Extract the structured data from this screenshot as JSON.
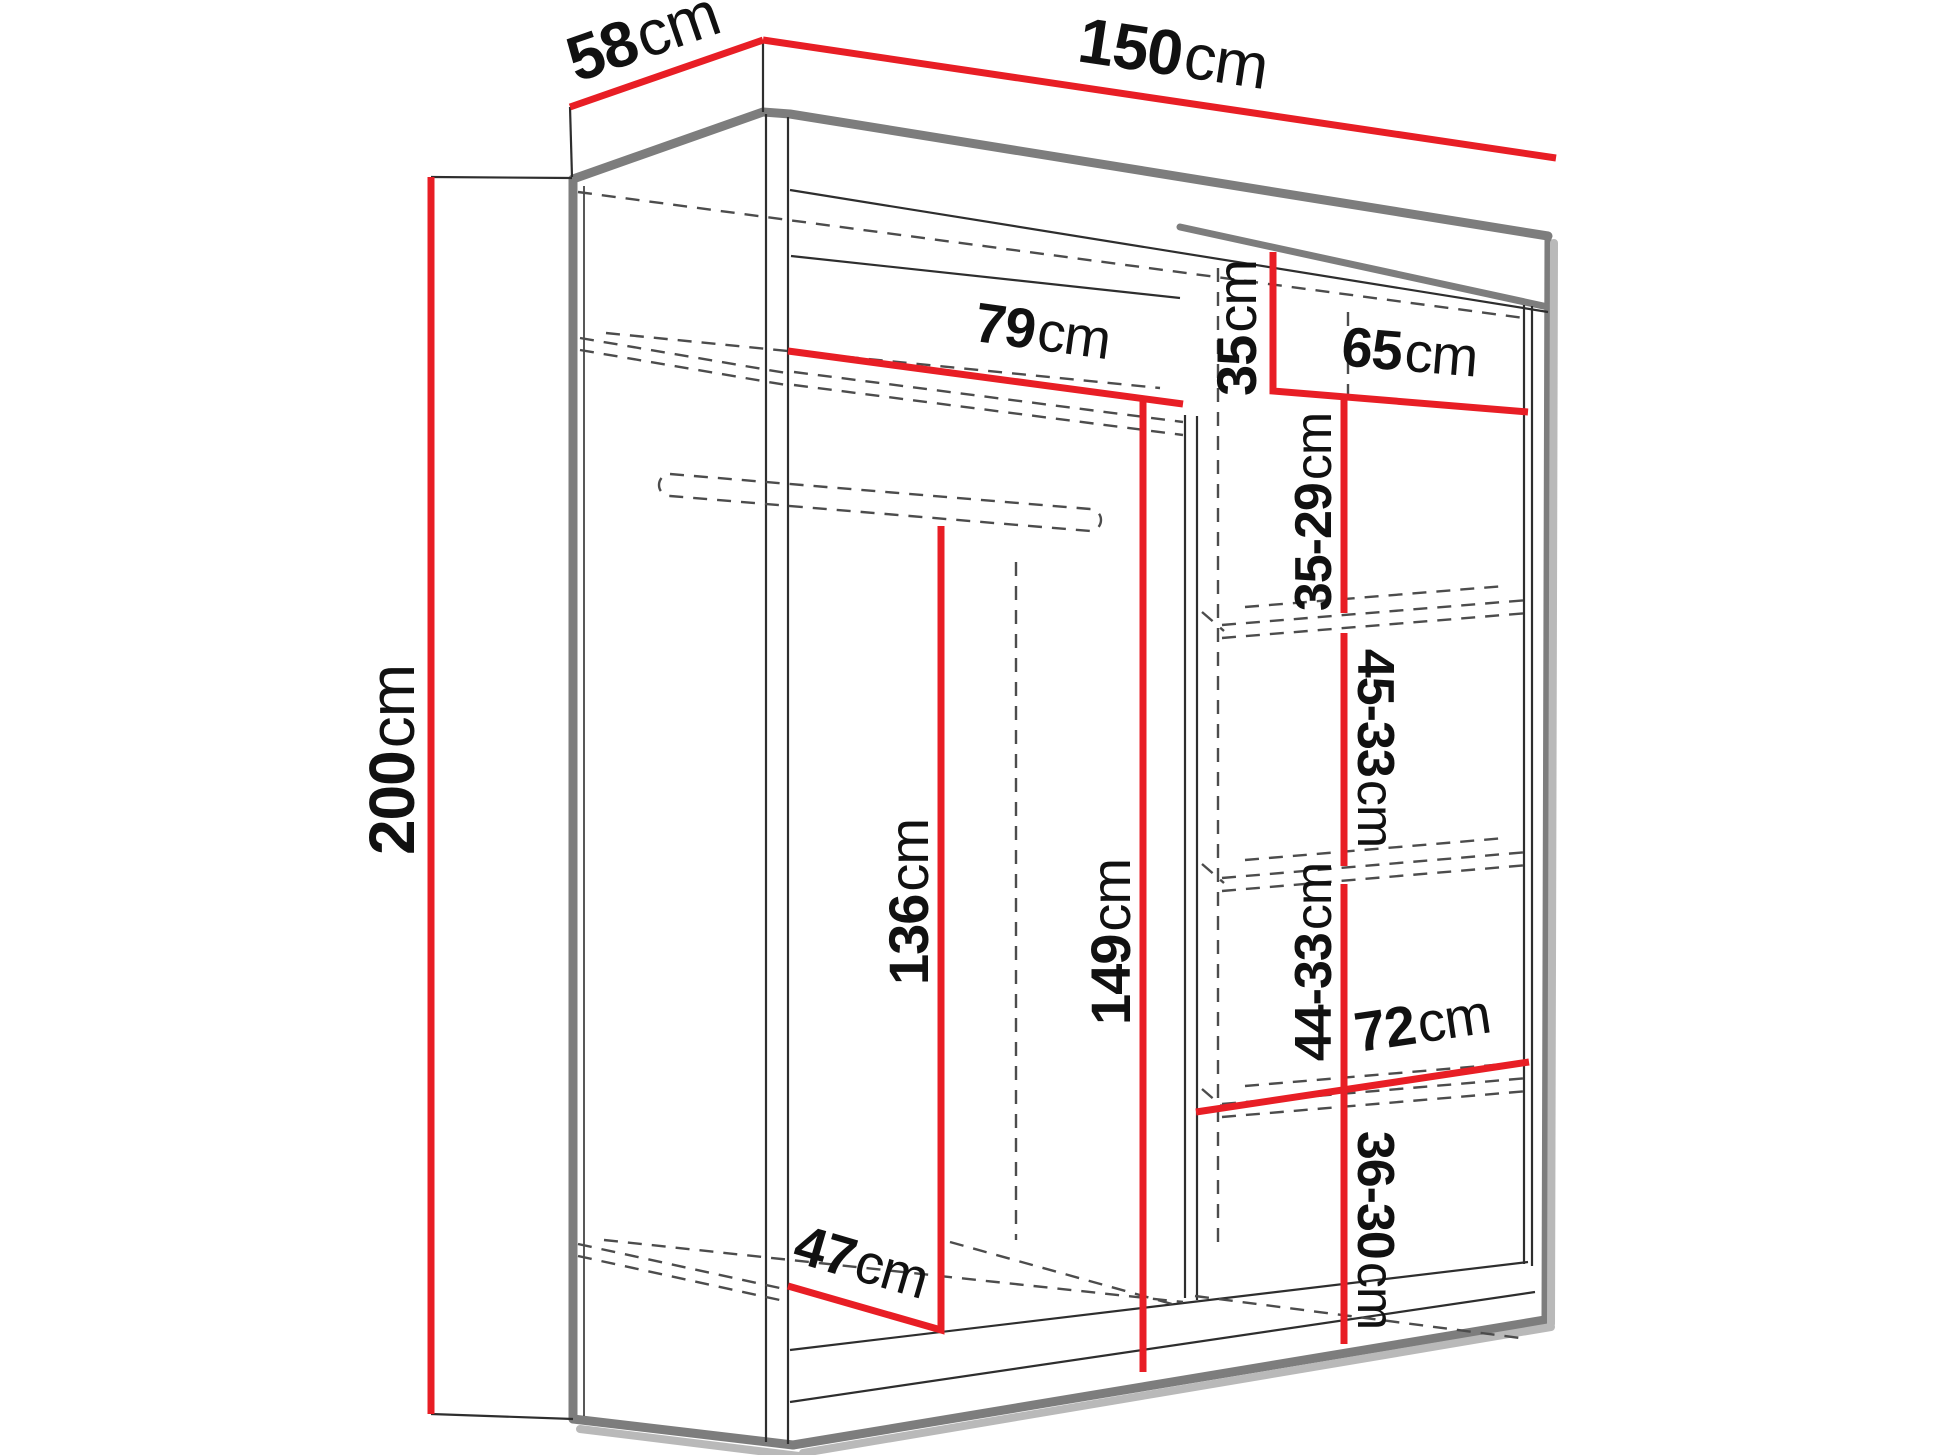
{
  "diagram": {
    "type": "wardrobe-dimension-diagram",
    "background": "#ffffff"
  },
  "colors": {
    "dimension": "#e81e25",
    "carcass": "#7d7d7d",
    "line": "#2e2e2e",
    "hidden": "#4c4c4c",
    "shadow": "#b9b9b9"
  },
  "dimensions": {
    "overall_depth": {
      "value": "58",
      "unit": "cm"
    },
    "overall_width": {
      "value": "150",
      "unit": "cm"
    },
    "overall_height": {
      "value": "200",
      "unit": "cm"
    },
    "left_section_width": {
      "value": "79",
      "unit": "cm"
    },
    "top_shelf_height": {
      "value": "35",
      "unit": "cm"
    },
    "right_section_width": {
      "value": "65",
      "unit": "cm"
    },
    "shelf_gap_1": {
      "value": "35-29",
      "unit": "cm"
    },
    "shelf_gap_2": {
      "value": "45-33",
      "unit": "cm"
    },
    "hanging_height": {
      "value": "136",
      "unit": "cm"
    },
    "left_section_height": {
      "value": "149",
      "unit": "cm"
    },
    "shelf_gap_3": {
      "value": "44-33",
      "unit": "cm"
    },
    "bottom_shelf_width": {
      "value": "72",
      "unit": "cm"
    },
    "shelf_gap_4": {
      "value": "36-30",
      "unit": "cm"
    },
    "interior_depth": {
      "value": "47",
      "unit": "cm"
    }
  }
}
